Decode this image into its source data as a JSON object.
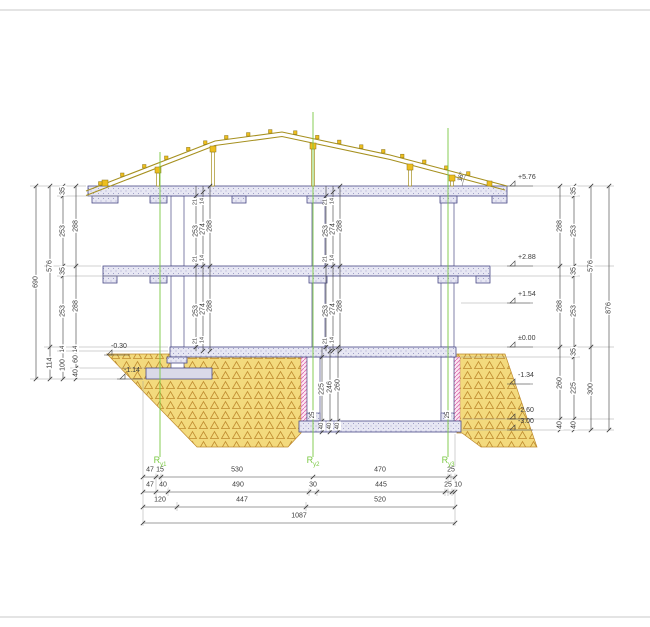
{
  "colors": {
    "ground": "#f3da7d",
    "ground_pattern": "#bf8b2e",
    "slab": "#e7e7f3",
    "slab_dot": "#8a8abd",
    "outline": "#4a4a86",
    "timber": "#a6901f",
    "timber_fill": "#edbe1e",
    "insulation_pink": "#e070b0",
    "axis_green": "#7ac943",
    "dimension": "#3a3a3a",
    "extension": "#9a9a9a",
    "frame": "#c9c9c9"
  },
  "labels": {
    "axes": [
      {
        "main": "R",
        "sub": "y1",
        "x": 160,
        "y": 456
      },
      {
        "main": "R",
        "sub": "y2",
        "x": 313,
        "y": 456
      },
      {
        "main": "R",
        "sub": "y3",
        "x": 448,
        "y": 456
      }
    ],
    "elevations": [
      {
        "text": "+5.76",
        "x": 513,
        "y": 184
      },
      {
        "text": "+2.88",
        "x": 513,
        "y": 264
      },
      {
        "text": "+1.54",
        "x": 513,
        "y": 301
      },
      {
        "text": "±0.00",
        "x": 513,
        "y": 345
      },
      {
        "text": "-1.34",
        "x": 513,
        "y": 382
      },
      {
        "text": "-2.60",
        "x": 513,
        "y": 417
      },
      {
        "text": "-3.00",
        "x": 513,
        "y": 428
      },
      {
        "text": "-0.30",
        "x": 106,
        "y": 353
      },
      {
        "text": "-1.14",
        "x": 119,
        "y": 377
      }
    ],
    "v_dims": [
      {
        "t": "690",
        "x": 36,
        "y": 282
      },
      {
        "t": "576",
        "x": 50,
        "y": 266
      },
      {
        "t": "114",
        "x": 50,
        "y": 363
      },
      {
        "t": "35",
        "x": 63,
        "y": 191
      },
      {
        "t": "253",
        "x": 63,
        "y": 231
      },
      {
        "t": "35",
        "x": 63,
        "y": 271
      },
      {
        "t": "253",
        "x": 63,
        "y": 311
      },
      {
        "t": "14",
        "x": 63,
        "y": 349,
        "fs": 6
      },
      {
        "t": "100",
        "x": 63,
        "y": 365
      },
      {
        "t": "288",
        "x": 76,
        "y": 226
      },
      {
        "t": "288",
        "x": 76,
        "y": 306
      },
      {
        "t": "14",
        "x": 76,
        "y": 349,
        "fs": 6
      },
      {
        "t": "60",
        "x": 76,
        "y": 359
      },
      {
        "t": "40",
        "x": 76,
        "y": 373
      },
      {
        "t": "288",
        "x": 560,
        "y": 226
      },
      {
        "t": "288",
        "x": 560,
        "y": 306
      },
      {
        "t": "260",
        "x": 560,
        "y": 383
      },
      {
        "t": "40",
        "x": 560,
        "y": 425
      },
      {
        "t": "35",
        "x": 574,
        "y": 191
      },
      {
        "t": "253",
        "x": 574,
        "y": 231
      },
      {
        "t": "35",
        "x": 574,
        "y": 271
      },
      {
        "t": "253",
        "x": 574,
        "y": 311
      },
      {
        "t": "35",
        "x": 574,
        "y": 352
      },
      {
        "t": "225",
        "x": 574,
        "y": 388
      },
      {
        "t": "40",
        "x": 574,
        "y": 425
      },
      {
        "t": "576",
        "x": 591,
        "y": 266
      },
      {
        "t": "300",
        "x": 591,
        "y": 389
      },
      {
        "t": "876",
        "x": 609,
        "y": 308
      },
      {
        "t": "253",
        "x": 196,
        "y": 231
      },
      {
        "t": "274",
        "x": 203,
        "y": 229
      },
      {
        "t": "288",
        "x": 210,
        "y": 226
      },
      {
        "t": "253",
        "x": 196,
        "y": 311
      },
      {
        "t": "274",
        "x": 203,
        "y": 309
      },
      {
        "t": "288",
        "x": 210,
        "y": 306
      },
      {
        "t": "21",
        "x": 196,
        "y": 202,
        "fs": 5.5
      },
      {
        "t": "14",
        "x": 203,
        "y": 201,
        "fs": 5.5
      },
      {
        "t": "21",
        "x": 196,
        "y": 259,
        "fs": 5.5
      },
      {
        "t": "14",
        "x": 203,
        "y": 258,
        "fs": 5.5
      },
      {
        "t": "21",
        "x": 196,
        "y": 341,
        "fs": 5.5
      },
      {
        "t": "14",
        "x": 203,
        "y": 340,
        "fs": 5.5
      },
      {
        "t": "253",
        "x": 326,
        "y": 231
      },
      {
        "t": "274",
        "x": 333,
        "y": 229
      },
      {
        "t": "288",
        "x": 340,
        "y": 226
      },
      {
        "t": "253",
        "x": 326,
        "y": 311
      },
      {
        "t": "274",
        "x": 333,
        "y": 309
      },
      {
        "t": "288",
        "x": 340,
        "y": 306
      },
      {
        "t": "21",
        "x": 326,
        "y": 202,
        "fs": 5.5
      },
      {
        "t": "14",
        "x": 333,
        "y": 201,
        "fs": 5.5
      },
      {
        "t": "21",
        "x": 326,
        "y": 259,
        "fs": 5.5
      },
      {
        "t": "14",
        "x": 333,
        "y": 258,
        "fs": 5.5
      },
      {
        "t": "21",
        "x": 326,
        "y": 341,
        "fs": 5.5
      },
      {
        "t": "14",
        "x": 333,
        "y": 340,
        "fs": 5.5
      },
      {
        "t": "225",
        "x": 322,
        "y": 389
      },
      {
        "t": "246",
        "x": 330,
        "y": 387
      },
      {
        "t": "260",
        "x": 338,
        "y": 385
      },
      {
        "t": "40",
        "x": 322,
        "y": 426,
        "fs": 6
      },
      {
        "t": "40",
        "x": 330,
        "y": 426,
        "fs": 6
      },
      {
        "t": "40",
        "x": 338,
        "y": 426,
        "fs": 6
      },
      {
        "t": "25",
        "x": 313,
        "y": 415,
        "fs": 6
      },
      {
        "t": "25",
        "x": 448,
        "y": 415,
        "fs": 6
      }
    ],
    "h_dims": [
      {
        "t": "47",
        "x": 150,
        "y": 470
      },
      {
        "t": "15",
        "x": 160,
        "y": 470
      },
      {
        "t": "530",
        "x": 237,
        "y": 470
      },
      {
        "t": "470",
        "x": 380,
        "y": 470
      },
      {
        "t": "25",
        "x": 451,
        "y": 470
      },
      {
        "t": "47",
        "x": 150,
        "y": 485
      },
      {
        "t": "40",
        "x": 163,
        "y": 485
      },
      {
        "t": "490",
        "x": 238,
        "y": 485
      },
      {
        "t": "30",
        "x": 313,
        "y": 485
      },
      {
        "t": "445",
        "x": 381,
        "y": 485
      },
      {
        "t": "25",
        "x": 448,
        "y": 485
      },
      {
        "t": "10",
        "x": 458,
        "y": 485
      },
      {
        "t": "120",
        "x": 160,
        "y": 500
      },
      {
        "t": "447",
        "x": 242,
        "y": 500
      },
      {
        "t": "520",
        "x": 380,
        "y": 500
      },
      {
        "t": "1087",
        "x": 299,
        "y": 516
      }
    ],
    "angle": {
      "text": "16°",
      "x": 462,
      "y": 177
    }
  }
}
